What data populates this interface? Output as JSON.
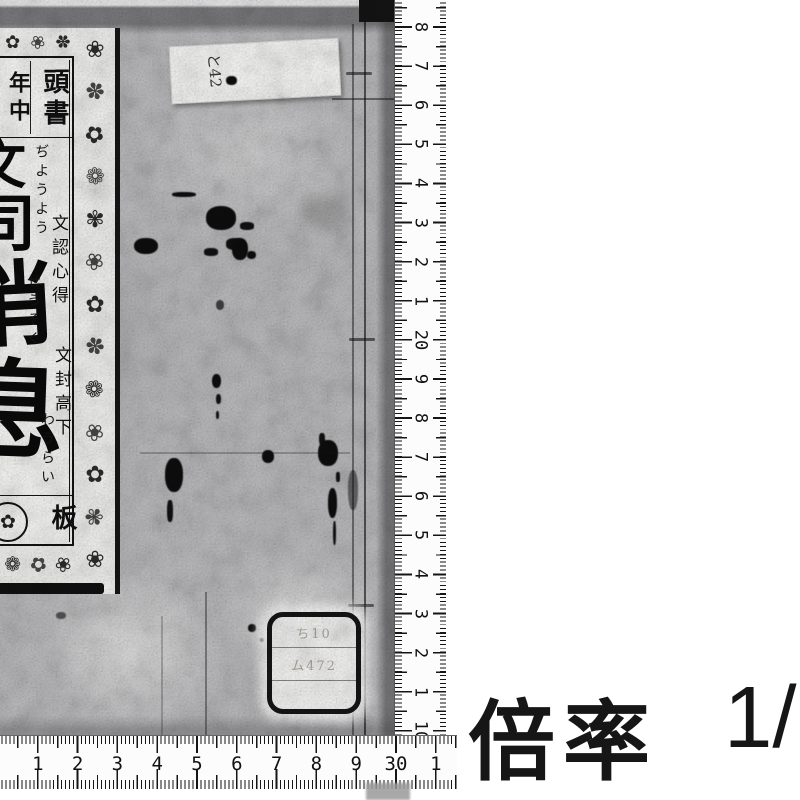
{
  "page": {
    "background": "#ffffff",
    "ink": "#141414"
  },
  "book_cover": {
    "title_slip": {
      "header": {
        "right_col": "頭書",
        "left_col": "年中"
      },
      "title_chars": [
        "文",
        "司",
        "消",
        "息"
      ],
      "furigana_cols": [
        "ぢようよう",
        "せうそく",
        "わうらい"
      ],
      "annotations": [
        "文認心得",
        "文封高下"
      ],
      "publisher": {
        "mark": "板",
        "crest_icon": "circular-crest"
      }
    },
    "paste_label": {
      "text": "と42"
    },
    "call_number_label": {
      "rows": [
        "ち10",
        "ム472",
        ""
      ]
    }
  },
  "rulers": {
    "horizontal": {
      "unit": "cm",
      "labels": [
        "20",
        "1",
        "2",
        "3",
        "4",
        "5",
        "6",
        "7",
        "8",
        "9",
        "30",
        "1"
      ]
    },
    "vertical": {
      "unit": "cm",
      "labels": [
        "8",
        "7",
        "6",
        "5",
        "4",
        "3",
        "2",
        "1",
        "20",
        "9",
        "8",
        "7",
        "6",
        "5",
        "4",
        "3",
        "2",
        "1",
        "10"
      ]
    }
  },
  "caption": {
    "prefix": "倍率",
    "ratio": "1/"
  },
  "ornaments": {
    "right_strip": [
      "❀",
      "✽",
      "✿",
      "❁",
      "✾",
      "❀",
      "✿",
      "✽",
      "❁",
      "❀",
      "✿",
      "✾",
      "❀"
    ],
    "top_strip": [
      "✿",
      "❀",
      "✽"
    ],
    "bottom_strip": [
      "❁",
      "✿",
      "❀"
    ]
  }
}
